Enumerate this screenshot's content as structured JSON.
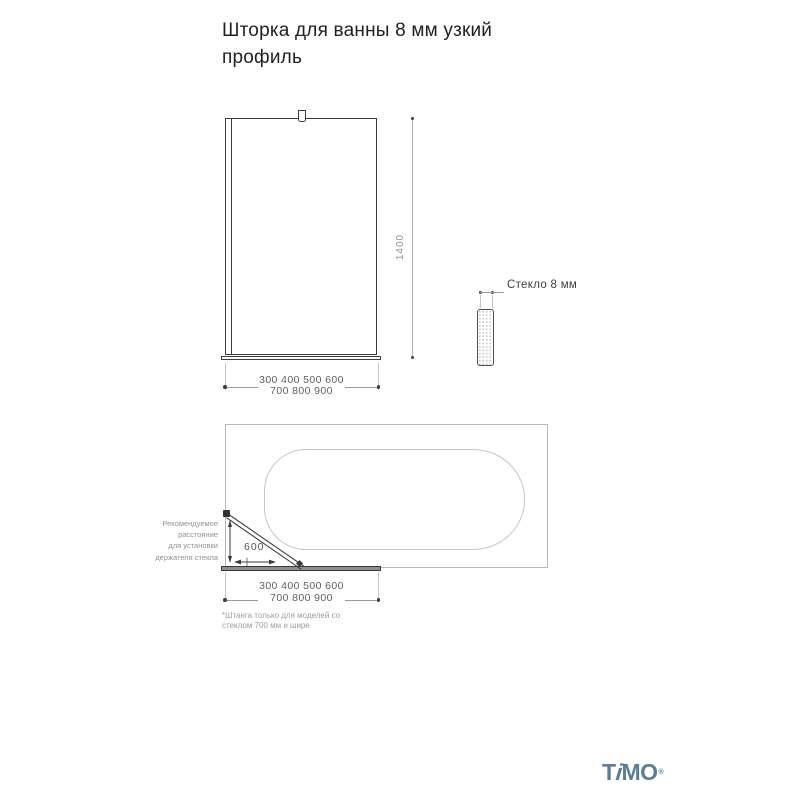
{
  "title": "Шторка для ванны 8 мм узкий профиль",
  "front_view": {
    "height_dim": "1400",
    "width_dims_line1": "300 400 500 600",
    "width_dims_line2": "700 800 900"
  },
  "glass_detail": {
    "label": "Стекло 8 мм"
  },
  "top_view": {
    "distance_dim": "600",
    "holder_note_lines": [
      "Рекомендуемое",
      "расстояние",
      "для установки",
      "держателя стекла"
    ],
    "width_dims_line1": "300 400 500 600",
    "width_dims_line2": "700 800 900",
    "footnote_lines": [
      "*Штанга только для моделей со",
      "стеклом 700 мм и шире"
    ]
  },
  "logo": {
    "part_t": "T",
    "part_i": "i",
    "part_mo": "MO",
    "trademark": "®"
  },
  "colors": {
    "line_dark": "#3b3b3b",
    "line_light": "#b8b8b8",
    "dim_text": "#5f5f5f",
    "note_text": "#909090",
    "logo_blue": "#5b7e96"
  }
}
